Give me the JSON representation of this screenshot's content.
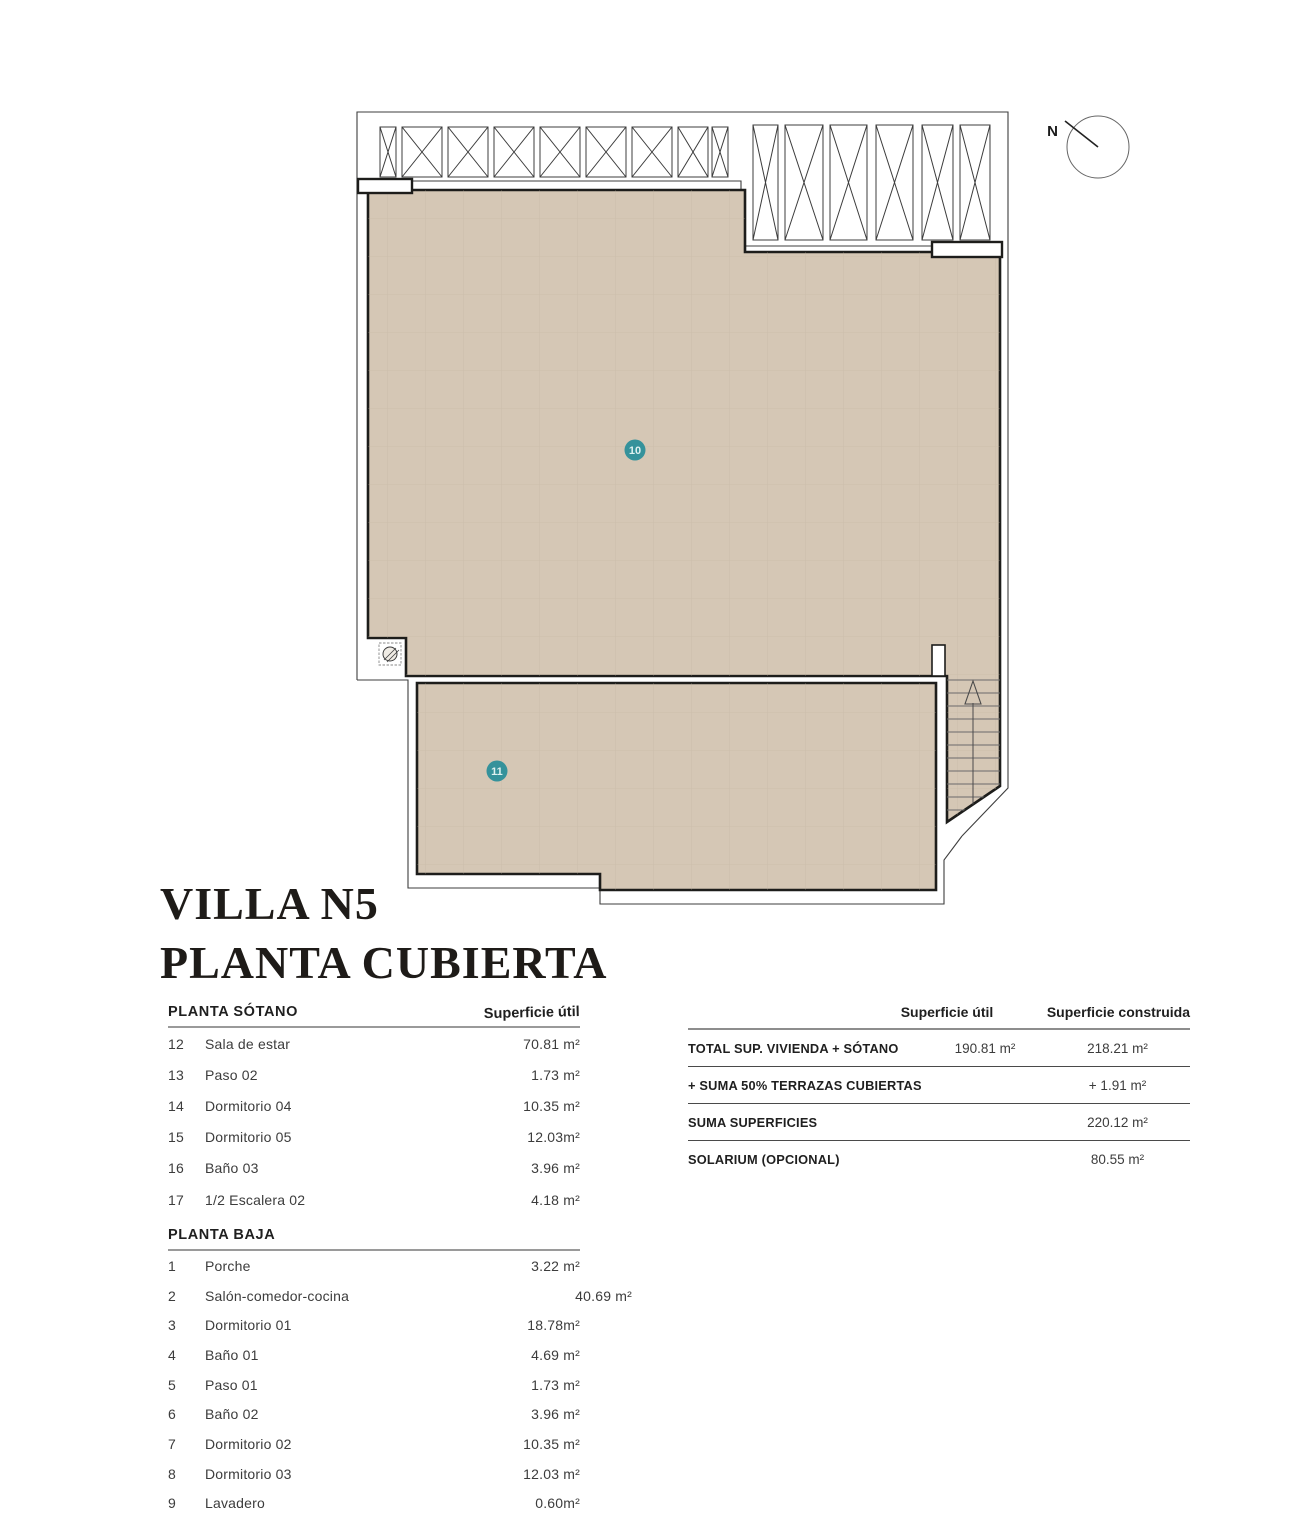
{
  "title": {
    "line1": "VILLA N5",
    "line2": "PLANTA CUBIERTA"
  },
  "plan": {
    "north_label": "N",
    "area10_label": "10",
    "area11_label": "11",
    "colors": {
      "roof_fill": "#d5c7b5",
      "outline": "#1d1d1b",
      "thin_line": "#3e3e3e",
      "badge": "#35929b",
      "grid": "#c0b2a0"
    }
  },
  "left_table": {
    "sotano": {
      "header": "PLANTA SÓTANO",
      "col_header": "Superficie útil",
      "rows": [
        {
          "num": "12",
          "name": "Sala de estar",
          "value": "70.81 m²"
        },
        {
          "num": "13",
          "name": "Paso 02",
          "value": "1.73 m²"
        },
        {
          "num": "14",
          "name": "Dormitorio 04",
          "value": "10.35 m²"
        },
        {
          "num": "15",
          "name": "Dormitorio 05",
          "value": "12.03m²"
        },
        {
          "num": "16",
          "name": "Baño 03",
          "value": "3.96 m²"
        },
        {
          "num": "17",
          "name": "1/2 Escalera 02",
          "value": "4.18 m²"
        }
      ]
    },
    "baja": {
      "header": "PLANTA BAJA",
      "rows": [
        {
          "num": "1",
          "name": "Porche",
          "value": "3.22 m²"
        },
        {
          "num": "2",
          "name": "Salón-comedor-cocina",
          "value": "40.69 m²",
          "row_class": "value-offset"
        },
        {
          "num": "3",
          "name": "Dormitorio 01",
          "value": "18.78m²"
        },
        {
          "num": "4",
          "name": "Baño 01",
          "value": "4.69 m²"
        },
        {
          "num": "5",
          "name": "Paso 01",
          "value": "1.73 m²"
        },
        {
          "num": "6",
          "name": "Baño 02",
          "value": "3.96 m²"
        },
        {
          "num": "7",
          "name": "Dormitorio 02",
          "value": "10.35 m²"
        },
        {
          "num": "8",
          "name": "Dormitorio 03",
          "value": "12.03 m²"
        },
        {
          "num": "9",
          "name": "Lavadero",
          "value": "0.60m²"
        }
      ]
    }
  },
  "summary_table": {
    "col1_header": "Superficie útil",
    "col2_header": "Superficie construida",
    "rows": [
      {
        "label": "TOTAL SUP. VIVIENDA + SÓTANO",
        "col1": "190.81  m²",
        "col2": "218.21 m²",
        "row_class": "with-line"
      },
      {
        "label": "+ SUMA 50% TERRAZAS CUBIERTAS",
        "col1": "",
        "col2": "+ 1.91 m²",
        "row_class": "with-line"
      },
      {
        "label": "SUMA SUPERFICIES",
        "col1": "",
        "col2": "220.12 m²",
        "row_class": "with-line"
      },
      {
        "label": "SOLARIUM (OPCIONAL)",
        "col1": "",
        "col2": "80.55 m²",
        "row_class": ""
      }
    ]
  }
}
